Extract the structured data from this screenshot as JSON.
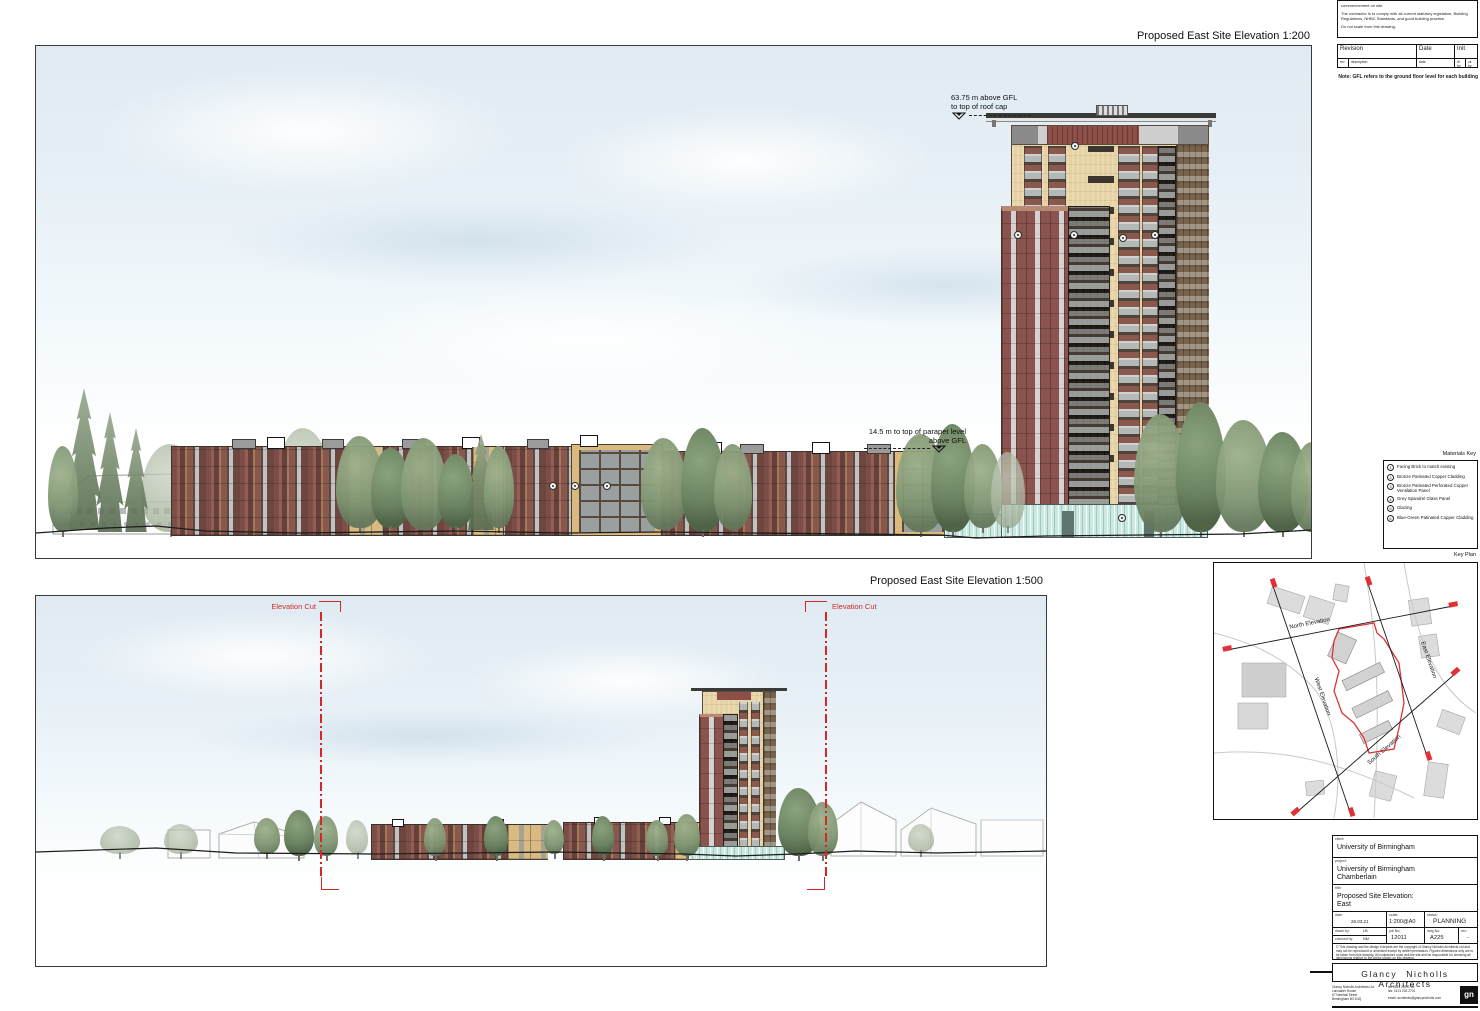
{
  "titles": {
    "elevation_200": "Proposed East Site Elevation 1:200",
    "elevation_500": "Proposed East Site Elevation 1:500"
  },
  "annotations": {
    "roof_line1": "63.75 m above GFL",
    "roof_line2": "to top of roof cap",
    "parapet_line1": "14.5 m to top of parapet level",
    "parapet_line2": "above GFL",
    "elevation_cut_left": "Elevation Cut",
    "elevation_cut_right": "Elevation Cut",
    "gfl_note": "Note: GFL refers to the ground floor level for each building"
  },
  "notes_box": {
    "line1": "commencement on site.",
    "line2": "The contractor is to comply with all current statutory legislation, Building Regulations, NHBC Standards, and good building practice.",
    "line3": "Do not scale from this drawing."
  },
  "revision_table": {
    "col_revision": "Revision",
    "col_date": "Date",
    "col_init": "Init",
    "sub_rev": "rev",
    "sub_description": "description",
    "sub_date": "date",
    "sub_drby": "dr by",
    "sub_ckby": "ck by"
  },
  "materials_key": {
    "title": "Materials Key",
    "items": [
      {
        "num": "1",
        "label": "Facing Brick to match existing"
      },
      {
        "num": "2",
        "label": "Bronze Patinated Copper Cladding"
      },
      {
        "num": "3",
        "label": "Bronze Patinated Perforated Copper Ventilation Panel"
      },
      {
        "num": "4",
        "label": "Grey Spandrel Glass Panel"
      },
      {
        "num": "5",
        "label": "Glazing"
      },
      {
        "num": "6",
        "label": "Blue-Green Patinated Copper Cladding"
      }
    ]
  },
  "key_plan": {
    "title": "Key Plan",
    "label_north": "North Elevation",
    "label_east": "East Elevation",
    "label_west": "West Elevation",
    "label_south": "South Elevation"
  },
  "title_block": {
    "client_label": "client:",
    "client": "University of Birmingham",
    "project_label": "project:",
    "project_line1": "University of Birmingham",
    "project_line2": "Chamberlain",
    "title_label": "title:",
    "title_line1": "Proposed Site Elevation:",
    "title_line2": "East",
    "date_label": "date:",
    "date": "26.03.21",
    "scale_label": "scale:",
    "scale": "1:200@A0",
    "status_label": "status:",
    "status": "PLANNING",
    "drawn_label": "drawn by:",
    "drawn": "LB",
    "checked_label": "checked by:",
    "checked": "NM",
    "job_label": "job No:",
    "job_no": "12011",
    "dwg_label": "dwg No:",
    "dwg_no": "A225",
    "rev_label": "rev:",
    "rev": "-",
    "copyright": "© This drawing and the design it depicts are the copyright of Glancy Nicholls Architects Ltd and may not be reproduced or amended except by written permission. Figured dimensions only are to be taken from this drawing. All contractors must visit the site and be responsible for checking all dimensions relative to the works shown on this drawing."
  },
  "firm": {
    "name": "Glancy Nicholls Architects",
    "addr1": "Glancy Nicholls Architects Ltd",
    "addr2": "Lancaster House",
    "addr3": "67 Newhall Street",
    "addr4": "Birmingham B3 1NQ",
    "tel": "tel:   0121 233 2700",
    "fax": "fax:   0121 233 2701",
    "email": "email:  architects@glancynicholls.com",
    "logo": "gn"
  },
  "colors": {
    "cut_line_red": "#d42828",
    "site_boundary_red": "#e03236",
    "facing_brick": "#e6d2a3",
    "copper_cladding": "#8a534e",
    "blue_green_copper": "#c9e9e1",
    "spandrel_grey": "#b4b8b7"
  }
}
